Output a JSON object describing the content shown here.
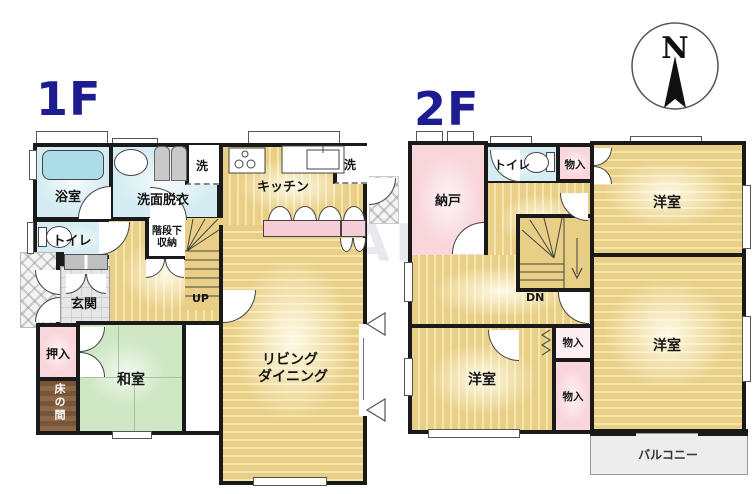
{
  "colors": {
    "wall": "#1a1a1a",
    "wood": "#e9cf86",
    "wet": "#d5edf2",
    "pink": "#f9d6dc",
    "tatami": "#cfe7c5",
    "tile": "#e6e6e6",
    "floorlabel": "#1d1c90",
    "balcony": "#ededed",
    "tokonoma": "#7d5a38"
  },
  "floor1": {
    "label": "1F",
    "rooms": {
      "bathroom": "浴室",
      "washroom": "洗面脱衣",
      "laundry_left": "洗",
      "laundry_right": "洗",
      "kitchen": "キッチン",
      "toilet": "トイレ",
      "understairs_1": "階段下",
      "understairs_2": "収納",
      "stairs_up": "UP",
      "entrance": "玄関",
      "closet": "押入",
      "tokonoma": "床の間",
      "japanese_room": "和室",
      "living_1": "リビング",
      "living_2": "ダイニング"
    }
  },
  "floor2": {
    "label": "2F",
    "rooms": {
      "storeroom": "納戸",
      "toilet": "トイレ",
      "closet_top": "物入",
      "closet_mid": "物入",
      "closet_bottom": "物入",
      "western_ne": "洋室",
      "western_se": "洋室",
      "western_sw": "洋室",
      "stairs_down": "DN",
      "balcony": "バルコニー"
    }
  },
  "compass": {
    "north": "N"
  },
  "watermark": "LALAHOUSE"
}
